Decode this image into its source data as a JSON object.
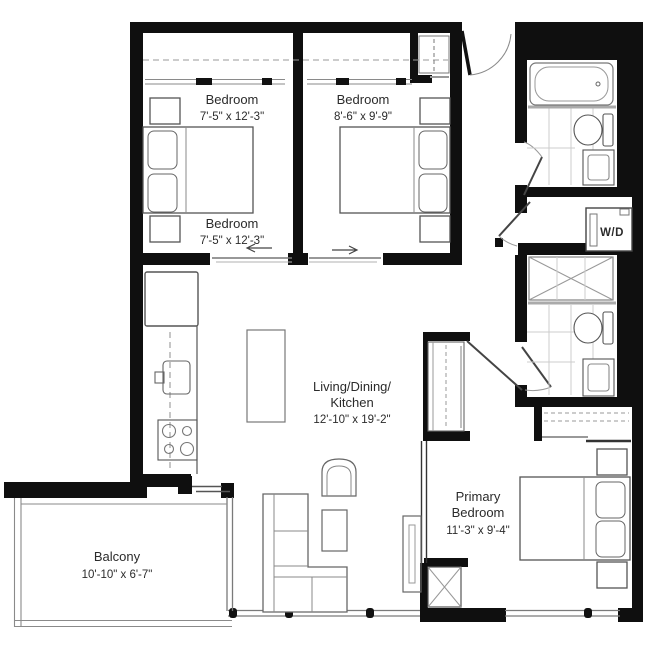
{
  "plan": {
    "type": "apartment-floor-plan",
    "colors": {
      "wall": "#0f0f0f",
      "furniture_line": "#555555",
      "light_line": "#8a8a8a",
      "tile_line": "#cccccc",
      "text": "#2b2b2b",
      "background": "#ffffff"
    },
    "labels": {
      "bedroom1_top": {
        "name": "Bedroom",
        "dims": "7'-5\" x 12'-3\""
      },
      "bedroom1_bottom": {
        "name": "Bedroom",
        "dims": "7'-5\" x 12'-3\""
      },
      "bedroom2": {
        "name": "Bedroom",
        "dims": "8'-6\" x 9'-9\""
      },
      "living": {
        "line1": "Living/Dining/",
        "line2": "Kitchen",
        "dims": "12'-10\" x 19'-2\""
      },
      "primary": {
        "line1": "Primary",
        "line2": "Bedroom",
        "dims": "11'-3\" x 9'-4\""
      },
      "balcony": {
        "name": "Balcony",
        "dims": "10'-10\" x 6'-7\""
      },
      "laundry": {
        "label": "W/D"
      }
    }
  }
}
